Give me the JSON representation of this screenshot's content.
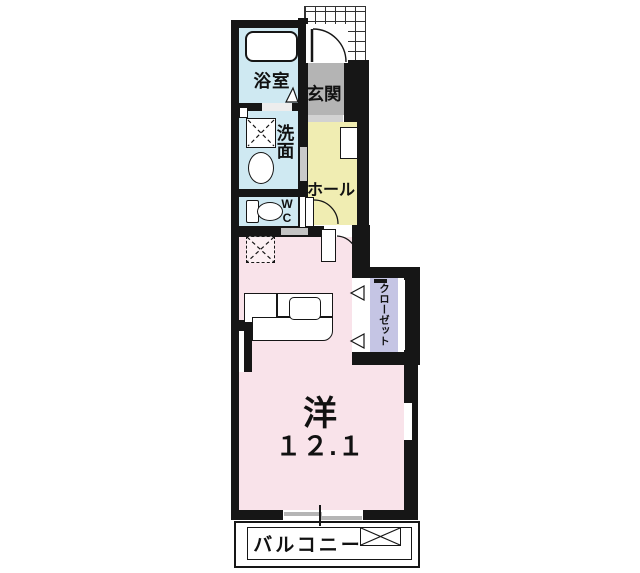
{
  "floorplan": {
    "bathroom_label": "浴室",
    "washroom_label": "洗面",
    "wc_label": "WC",
    "entrance_label": "玄関",
    "hall_label": "ホール",
    "closet_label": "クローゼット",
    "room_type_label": "洋",
    "room_size_label": "１２.１",
    "balcony_label": "バルコニー",
    "colors": {
      "wall": "#161616",
      "wet_area_floor": "#cfe9f2",
      "hall_floor": "#f0edb2",
      "entrance_floor": "#b4b4b4",
      "room_floor": "#f9e3ea",
      "closet_fill": "#c5c5e4",
      "door_bar_gray": "#c9c9c9"
    }
  }
}
